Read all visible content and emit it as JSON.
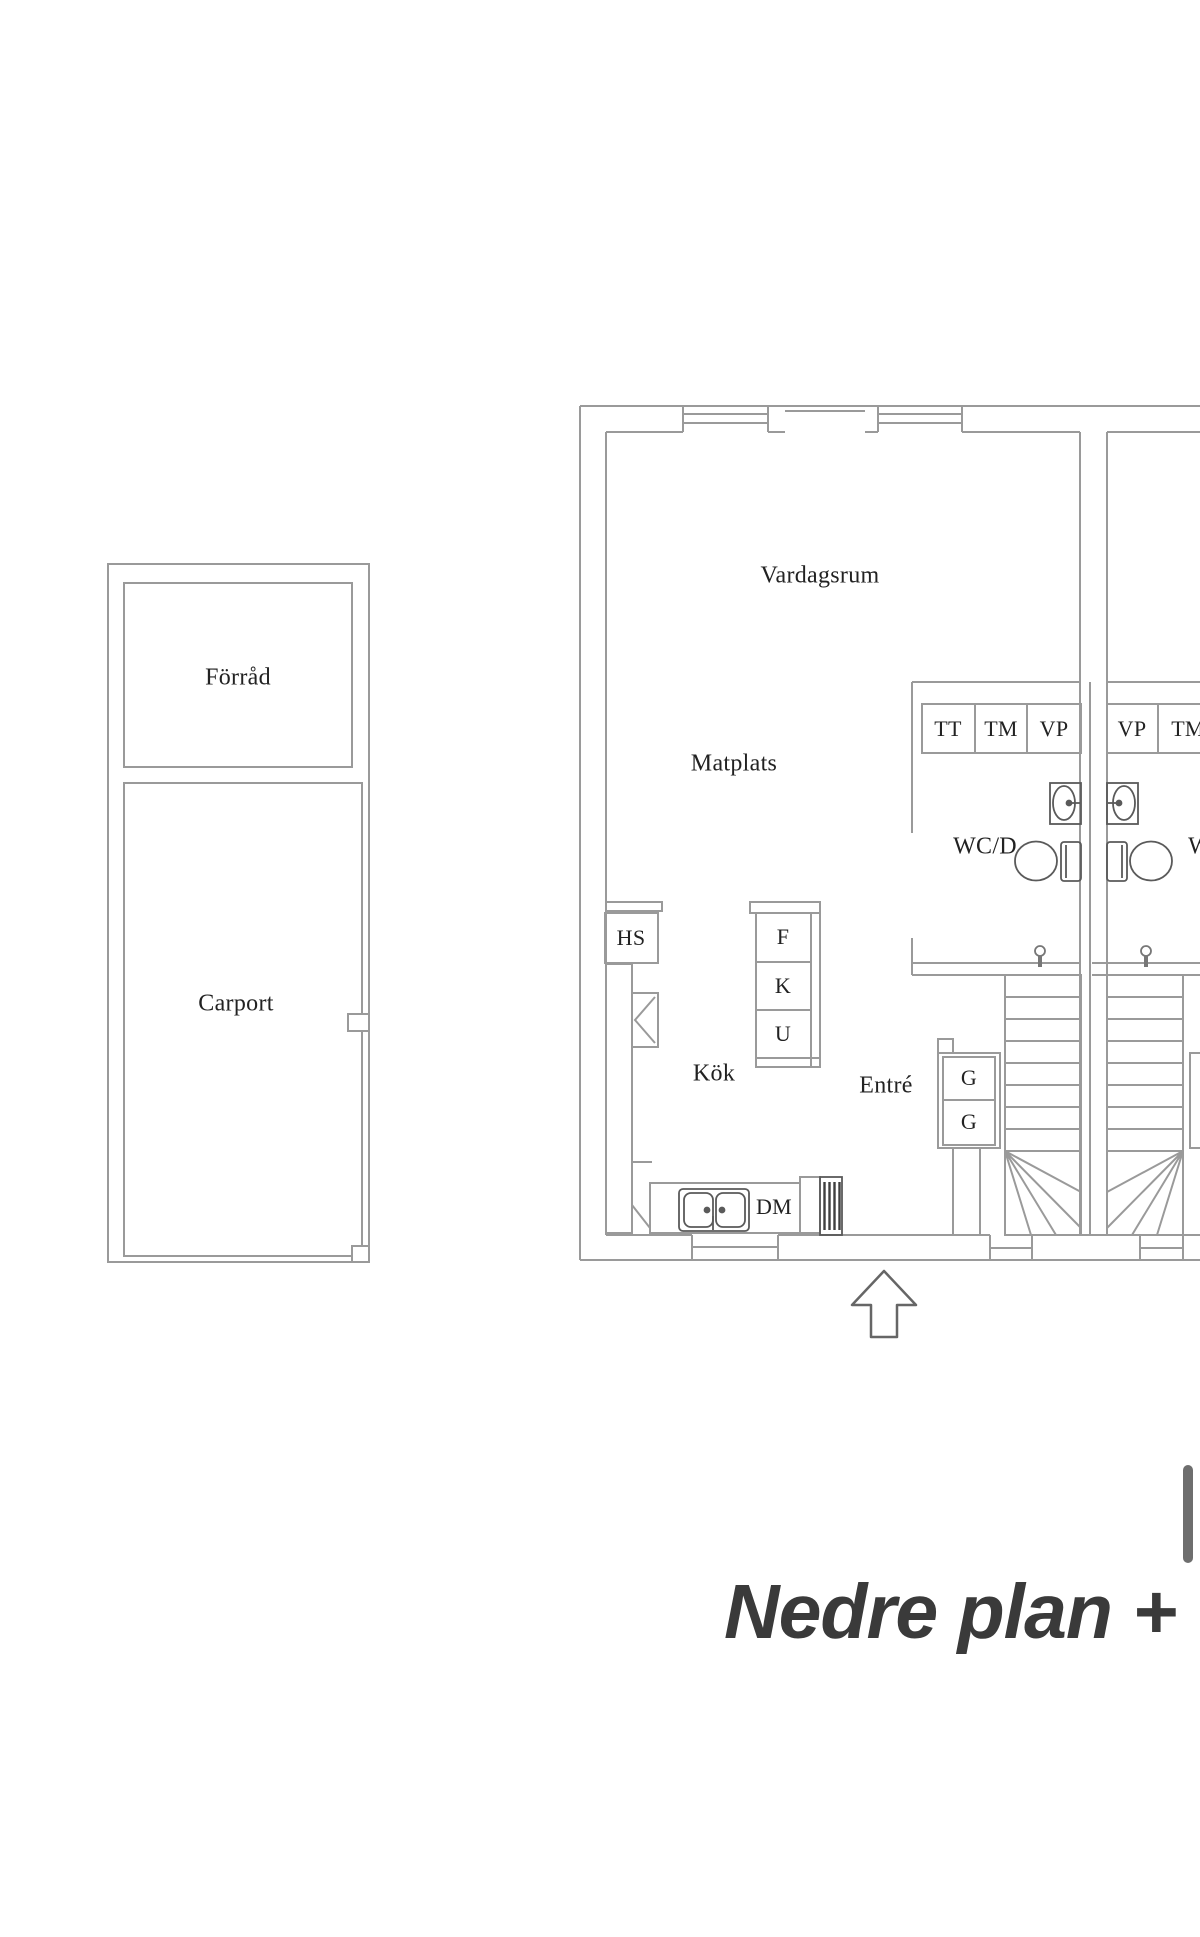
{
  "title": {
    "text": "Nedre plan + C"
  },
  "outbuilding": {
    "storage_label": "Förråd",
    "carport_label": "Carport"
  },
  "floorplan": {
    "living_room_label": "Vardagsrum",
    "dining_label": "Matplats",
    "kitchen_label": "Kök",
    "entry_label": "Entré",
    "wc_left_label": "WC/D",
    "wc_right_label": "WC/D",
    "appliance_row_left": [
      "TT",
      "TM",
      "VP"
    ],
    "appliance_row_right": [
      "VP",
      "TM"
    ],
    "kitchen_units": [
      "F",
      "K",
      "U"
    ],
    "hs_label": "HS",
    "dm_label": "DM",
    "wardrobes": [
      "G",
      "G"
    ]
  },
  "colors": {
    "wall_line": "#9a9a9a",
    "fixture_line": "#5a5a5a",
    "radiator_bar": "#3f3f3f",
    "label_text": "#222222",
    "title_text": "#3a3a3a",
    "logo_bar": "#6e6e6e",
    "arrow_outline": "#666666"
  }
}
